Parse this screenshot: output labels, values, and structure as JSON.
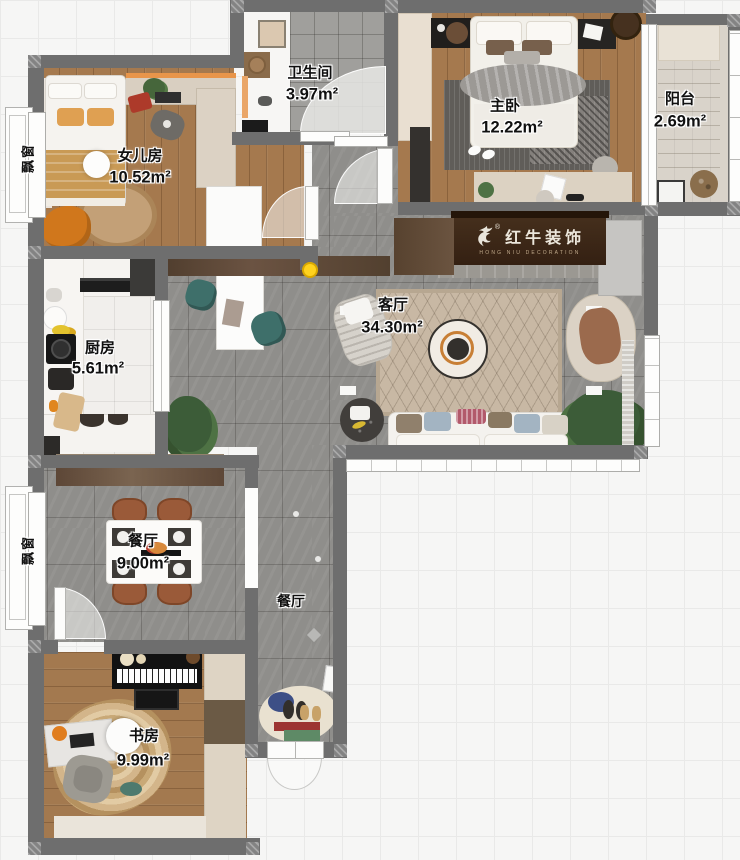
{
  "fp": {
    "rooms": [
      {
        "id": "girls-room",
        "name": "女儿房",
        "area": "10.52m²"
      },
      {
        "id": "bathroom",
        "name": "卫生间",
        "area": "3.97m²"
      },
      {
        "id": "master-bedroom",
        "name": "主卧",
        "area": "12.22m²"
      },
      {
        "id": "balcony",
        "name": "阳台",
        "area": "2.69m²"
      },
      {
        "id": "living-room",
        "name": "客厅",
        "area": "34.30m²"
      },
      {
        "id": "kitchen",
        "name": "厨房",
        "area": "5.61m²"
      },
      {
        "id": "dining-room",
        "name": "餐厅",
        "area": "9.00m²"
      },
      {
        "id": "study",
        "name": "书房",
        "area": "9.99m²"
      }
    ],
    "hallway_label": "餐厅",
    "bay_windows": [
      {
        "label": "飘窗"
      },
      {
        "label": "飘窗"
      }
    ],
    "brand": {
      "name": "红牛装饰",
      "registered": "®",
      "subtitle": "HONG NIU DECORATION"
    },
    "colors": {
      "wall": "#6e6e6e",
      "wood_floor": "#a5794e",
      "tile_floor": "#8f8e8b",
      "accent_marker": "#ffd21e",
      "brand_panel": "#3d2818"
    }
  }
}
